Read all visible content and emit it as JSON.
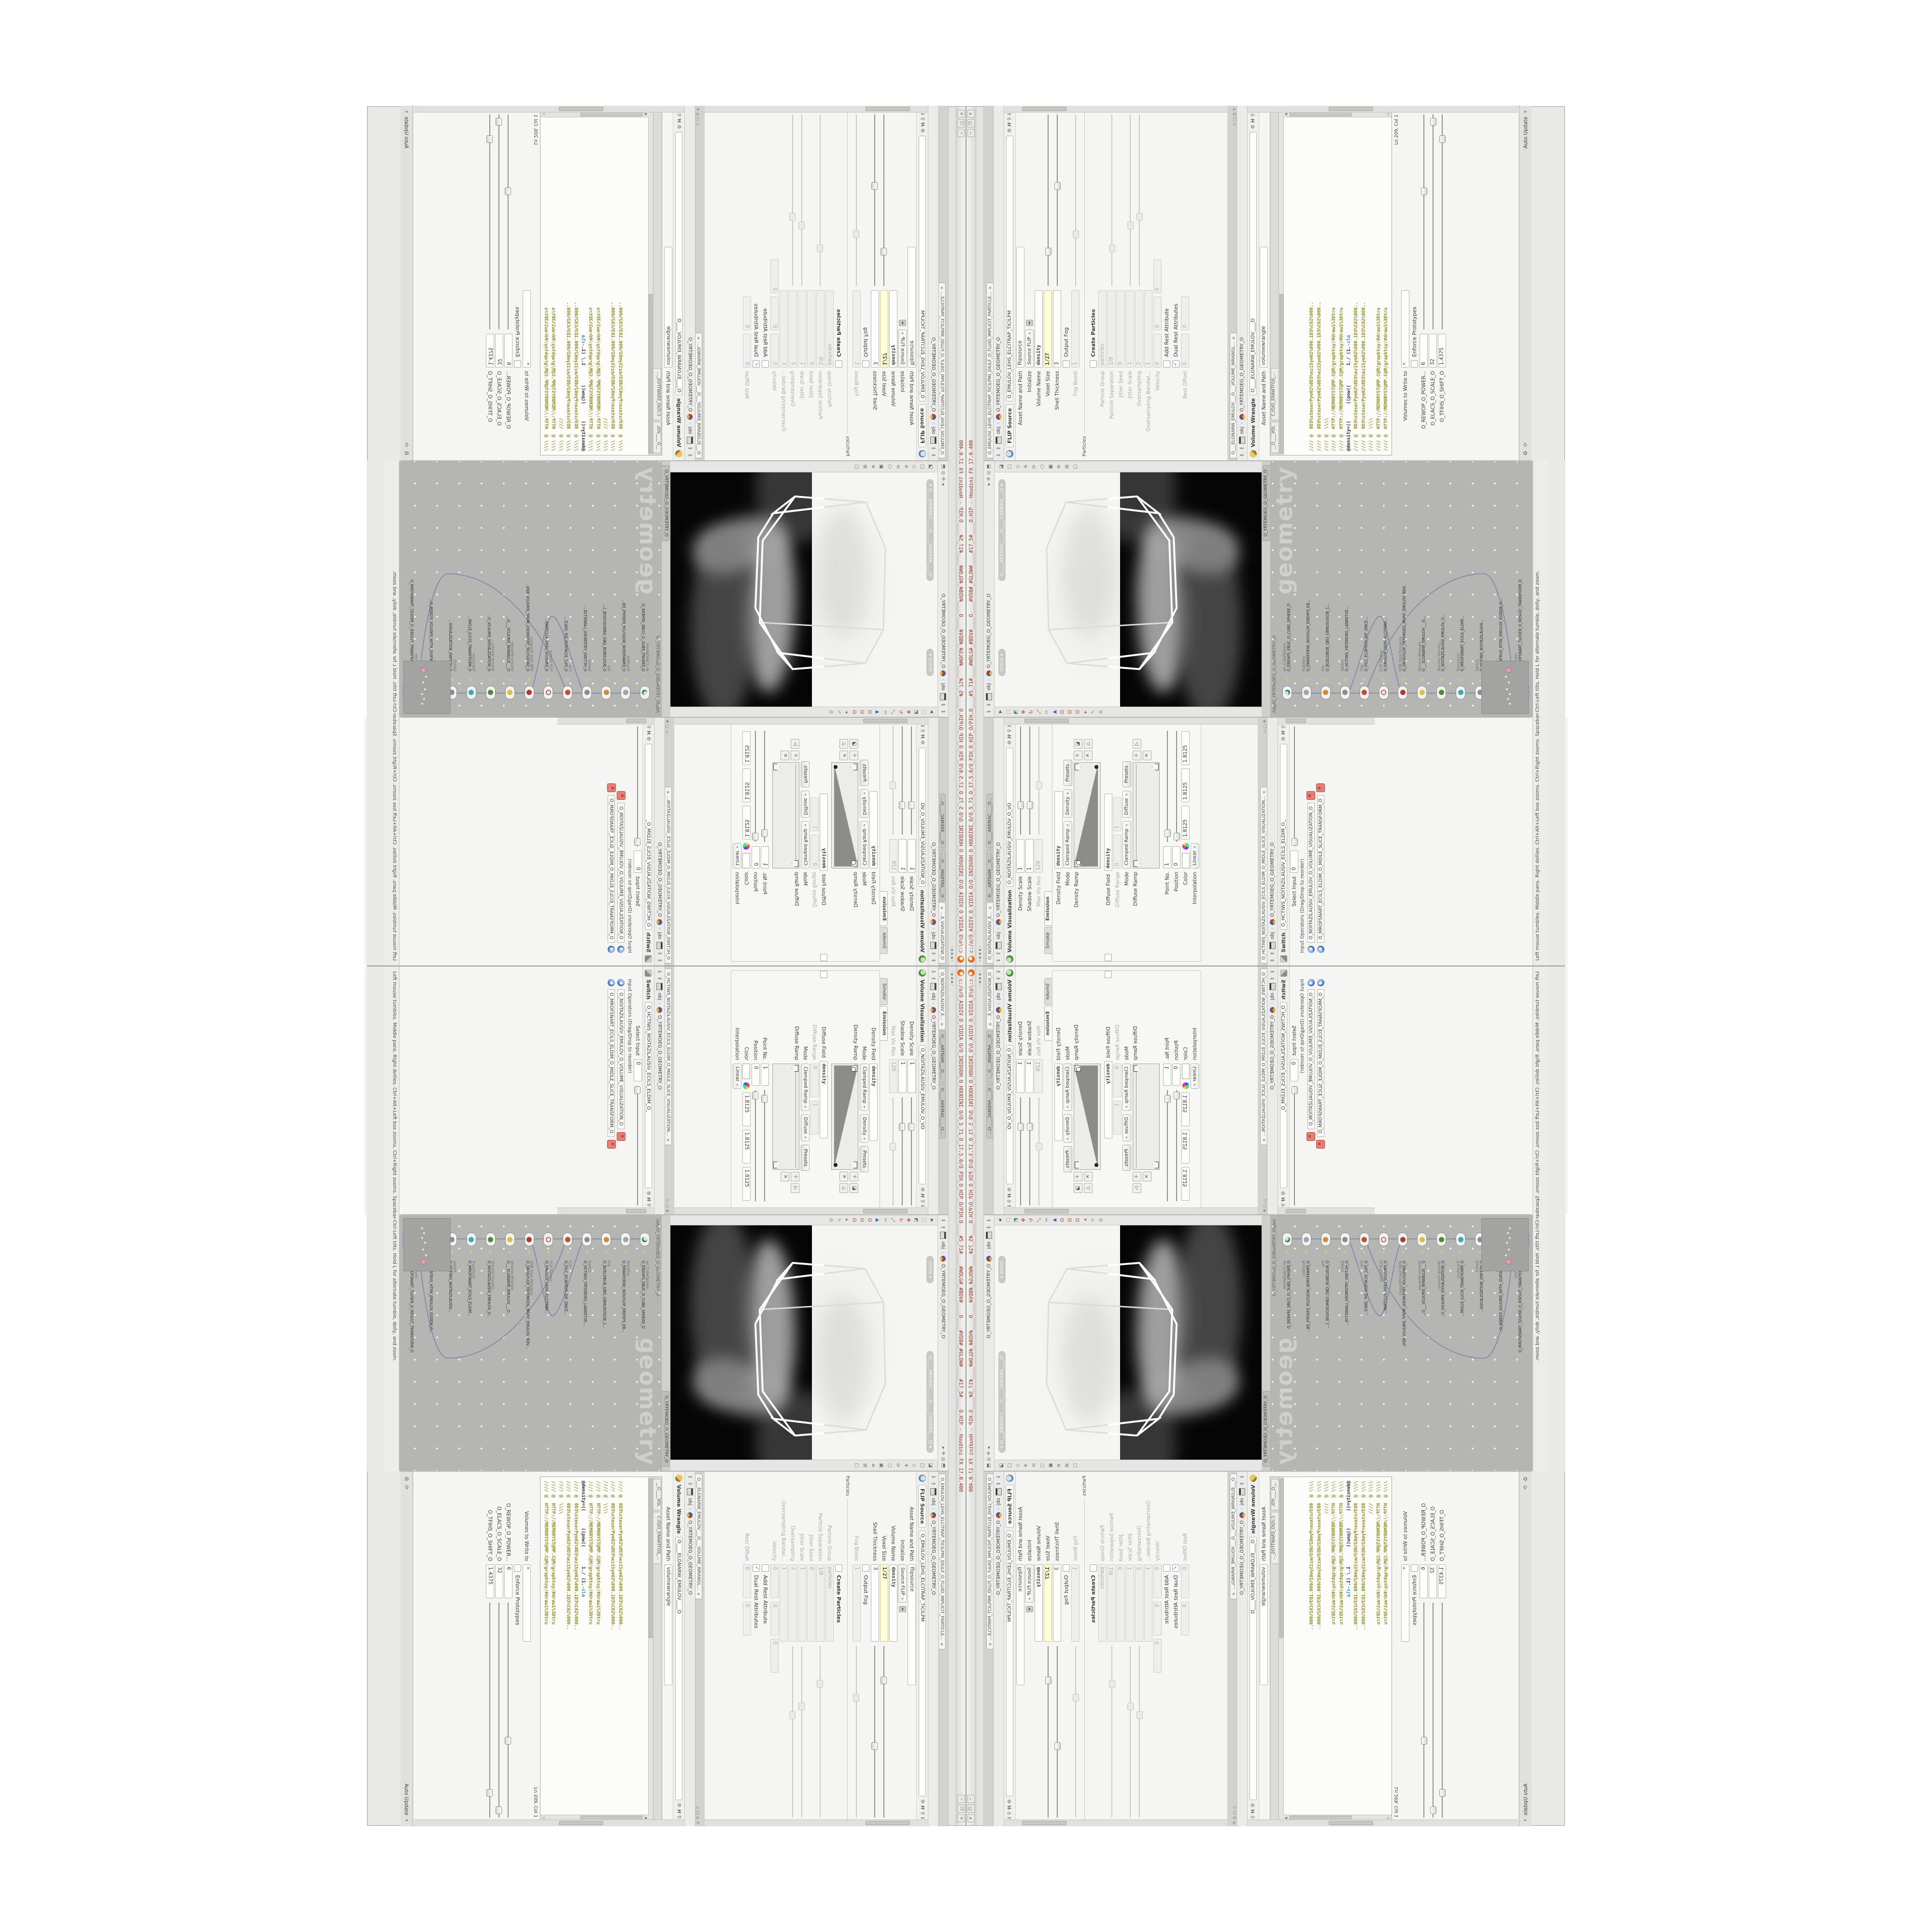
{
  "window": {
    "title": "c:/o/O_AIDIV_O_VIDIA_O/O_INIDUOH_O_HOUDINI_O/O_5_71_O_17.5.0/O_PIH_O_HIP_O/PIH.O____#5_71#____#WOLG#_#BDV#____O____#VDB#_#GLOW#____#17_5#____O.HIP - Houdini FX 17.0.400",
    "buttons": [
      {
        "g": "─"
      },
      {
        "g": "❐"
      },
      {
        "g": "✕"
      }
    ]
  },
  "shelf_hint": "‹ ▪ ▪ ▪ ›",
  "status": "Left mouse tumbles.  Middle pans.  Right dollies.  Ctrl+Alt+Left box zooms.  Ctrl+Right zooms.  Spacebar-Ctrl-Left tilts.  Hold L for alternate tumble, dolly, and zoom.",
  "path": {
    "context": "obj",
    "node": "O_YRTEMOEG_O_GEOMETRY_O",
    "sep": "›"
  },
  "left": {
    "tabs": [
      {
        "t": "O_NOITAZILAUSIV_E...",
        "cls": "active",
        "x": true
      },
      {
        "t": "O___ARTNAM___O_...",
        "x": false
      },
      {
        "t": "O____AREMAC____O...",
        "x": false
      }
    ],
    "volvis": {
      "title": "Volume Visualization",
      "name_field": "O_NOITAZILAUSIV_EMULOV_O_VO",
      "density_scale_label": "Density Scale",
      "density_scale": "1",
      "shadow_scale_label": "Shadow Scale",
      "shadow_scale": "1",
      "max_vis_res_label": "Max Vis Res",
      "max_vis_res": "128",
      "tab_smoke": "Smoke",
      "tab_emission": "Emission",
      "density_field_label": "Density Field",
      "density_field": "density",
      "mode_label": "Mode",
      "mode1a": "Clamped Ramp",
      "mode1b": "Density",
      "presets": "Presets",
      "density_ramp_label": "Density Ramp",
      "diffuse_field_label": "Diffuse Field",
      "diffuse_field": "density",
      "diffuse_range_label": "Diffuse Range",
      "diffuse_range_min": "0",
      "diffuse_range_max": "1",
      "mode2a": "Clamped Ramp",
      "mode2b": "Diffuse",
      "diffuse_ramp_label": "Diffuse Ramp",
      "point_no_label": "Point No.",
      "point_no": "1",
      "position_label": "Position",
      "position": "0",
      "color_label": "Color",
      "color_r": "1.8125",
      "color_g": "1.8125",
      "color_b": "1.8125",
      "interpolation_label": "Interpolation",
      "interpolation": "Linear"
    },
    "switch": {
      "tab": "O_HCTIWS_NOITAZILAUSIV_ECILS_ELDIM_O_MIDLE_SLICE_VISUALIZATION...",
      "title": "Switch",
      "name_field": "O_HCTIWS_NOITAZILAUSIV_ECILS_ELDIM_O_",
      "select_input_label": "Select Input",
      "select_input": "0",
      "operators_label": "Input Operators (Drag/Drop to reorder)",
      "operators": [
        {
          "name": "O_NOITAZILAUSIV_EMULOV_O_VOLUME_VISUALIZATION_O"
        },
        {
          "name": "O_MROFSNART_ECILS_ELDIM_O_MIDLE_SLICE_TRANSFORM_O"
        }
      ]
    }
  },
  "viewport": {
    "camera_pill": "O____AREMAC____O____CAMERA___O",
    "ortho_pill": "Ortho",
    "left_tools": [
      {
        "g": "➤",
        "c": "c-dark"
      },
      {
        "g": "⬚",
        "c": "c-grey"
      },
      {
        "g": "◩",
        "c": "c-green"
      },
      {
        "g": "✥",
        "c": "c-red"
      },
      {
        "g": "↻",
        "c": "c-red"
      },
      {
        "g": "⤢",
        "c": "c-red"
      },
      {
        "g": "✂",
        "c": "c-grey"
      },
      {
        "g": "▲",
        "c": "c-blue"
      },
      {
        "g": "Ω",
        "c": "c-red"
      },
      {
        "g": "Ω",
        "c": "c-red"
      },
      {
        "g": "Ω",
        "c": "c-red"
      },
      {
        "g": "▸",
        "c": "c-grey"
      },
      {
        "g": "✎",
        "c": "c-yellow"
      },
      {
        "g": "⊙",
        "c": "c-grey"
      }
    ],
    "right_tools": [
      {
        "g": "◪",
        "c": "c-grey"
      },
      {
        "g": "□",
        "c": "c-grey"
      },
      {
        "g": "◇",
        "c": "c-grey"
      },
      {
        "g": "✛",
        "c": "c-grey"
      },
      {
        "g": "⟳",
        "c": "c-grey"
      },
      {
        "g": "⬡",
        "c": "c-grey"
      },
      {
        "g": "▣",
        "c": "c-grey"
      },
      {
        "g": "≡",
        "c": "c-grey"
      },
      {
        "g": "⊞",
        "c": "c-grey"
      },
      {
        "g": "▢",
        "c": "c-grey"
      }
    ]
  },
  "network": {
    "tab": "O_YRTEMOEG_O_GEOMETRY_O",
    "path": "/obj/O_YRTEMOEG_O_GEOMETRY_O",
    "watermark": "geometry",
    "nodes": [
      {
        "type": "an_CubeSphere",
        "name": "O_EREHPS_EBUC_O_CUBE_SPHERE_O",
        "icon": "globe"
      },
      {
        "type": "PolyWire",
        "name": "O_EMARFERIW_NOGYLOP_EREHPS_EB...",
        "icon": "wire"
      },
      {
        "type": "File",
        "name": "O_BUSLDBUB_QBO_GBNUSOGOB_1...",
        "icon": "file"
      },
      {
        "type": "Switch",
        "name": "O_HCTIWS_YRTEMOEG_LANRETXE...",
        "icon": "switch"
      },
      {
        "type": "Clip",
        "name": "O_PILC_ECAFRUS_DIF_DNCE...",
        "icon": "clip"
      },
      {
        "type": "FLIP Source",
        "name": "O_EMULOV_LEHS_ELCITRAP...",
        "icon": "flipn"
      },
      {
        "type": "VDB from Polygons",
        "name": "O_SNOGYLOP_YRTEMOEG_MORF_EMULOV_BDV...",
        "icon": "vdb"
      },
      {
        "type": "Volume Wrangle",
        "name": "O___ELGNARW_EMULOV___O...",
        "icon": "wrangn"
      },
      {
        "type": "Volume Visualiz...",
        "name": "O_NOITAZILAUSIV_EMULOV_O...",
        "icon": "volvisn"
      },
      {
        "type": "Transform",
        "name": "O_MROFSNART_ECILS_ELDIM...",
        "icon": "xform"
      },
      {
        "type": "Switch",
        "name": "O_HCTIWS_NOITAZILAUSIV...",
        "icon": "switch"
      },
      {
        "type": "Merge",
        "name": "O_ECAFRUS_HTIW_EMULOV_EGREM_O...",
        "icon": "merge"
      },
      {
        "type": "Transform",
        "name": "O_MROFSNART_TLUSER_O_RESULT_TRANSFORM_O",
        "icon": "xform",
        "cls": "sel"
      }
    ]
  },
  "flip": {
    "tab": "O_EMULOV_LEHS_ELCITRAP_TICILPMI_DIULF_O_FLUID_IMPLICIT_PARTICLE...",
    "node_type": "FLIP Source",
    "node_name": "O_EMULOV_LEHS_ELCITRAP_TICILPM",
    "asset_label": "Asset Name and Path",
    "asset": "flipsource",
    "initialize_label": "Initialize",
    "initialize": "Source FLIP",
    "volume_name_label": "Volume Name",
    "volume_name": "density",
    "voxel_size_label": "Voxel Size",
    "voxel_size": "1/27",
    "shell_label": "Shell Thickness",
    "shell": "3",
    "output_fog_label": "Output Fog",
    "fog_boost_label": "Fog Boost",
    "fog_boost": "1",
    "particles_section": "Particles",
    "create_particles_label": "Create Particles",
    "particle_group_label": "Particle Group",
    "particle_group": "particles",
    "particle_separation_label": "Particle Separation",
    "particle_separation": "1/9",
    "jitter_seed_label": "Jitter Seed",
    "jitter_seed": "0",
    "jitter_scale_label": "Jitter Scale",
    "jitter_scale": "1",
    "oversampling_label": "Oversampling",
    "oversampling": "2",
    "oversampling_bw_label": "Oversampling Bandwi...",
    "oversampling_bw": "1",
    "velocity_label": "Velocity",
    "vel_x": "0",
    "vel_y": "0",
    "vel_z": "0",
    "add_rest_label": "Add Rest Attribute",
    "dual_rest_label": "Dual Rest Attributes",
    "dual_rest_check": "✓",
    "rest_offset_label": "Rest Offset",
    "rest_offset": "0"
  },
  "wrangle": {
    "tab": "O___ELGNARW_EMULOV___O___VOLUME_WRANGL...",
    "node_type": "Volume Wrangle",
    "node_name": "O____ELGNARW_EMULOV____O",
    "asset_label": "Asset Name and Path",
    "asset": "volumewrangle",
    "editor_tabs": [
      {
        "t": "__O____VOL"
      },
      {
        "t": "C:/O/O_ERAWTFOS_..."
      }
    ],
    "code": [
      {
        "a": "//// @  0D3%steserPym62%0D3%eziSym62%000.1D3%C62%000..",
        "b": "",
        "cls": "ln-olive"
      },
      {
        "a": "//// @  0D3%steserPym62%0D3%eziSym62%000.1D3%C62%000..",
        "b": "",
        "cls": "ln-olive"
      },
      {
        "a": "//// @  \\\\\\\\",
        "b": "",
        "cls": "ln-olive"
      },
      {
        "a": "//// @  HTTP://MEMORYST@MP.C@M/graphtoy/#draw1%3Dtru",
        "b": "",
        "cls": "ln-olive"
      },
      {
        "a": "//// @  HTTP://MEMORYST@MP.C@M/graphtoy/#draw1%3Dtru",
        "b": "",
        "cls": "ln-olive"
      },
      {
        "a": "@density=((      ((pow((       1./ (1.",
        "b": "-cla",
        "cls": "ln-dark"
      },
      {
        "a": "//// @  0D3%steserPym62%0D3%eziSym62%000.1D3%C62%000..",
        "b": "",
        "cls": "ln-olive"
      },
      {
        "a": "//// @  0D3%steserPym62%0D3%eziSym62%000.1D3%C62%000..",
        "b": "",
        "cls": "ln-olive"
      },
      {
        "a": "//// @  \\\\\\\\",
        "b": "",
        "cls": "ln-olive"
      },
      {
        "a": "//// @  HTTP://MEMORYST@MP.C@M/graphtoy/#draw1%3Dtru",
        "b": "",
        "cls": "ln-olive"
      },
      {
        "a": "//// @  HTTP://MEMORYST@MP.C@M/graphtoy/#draw1%3Dtru",
        "b": "",
        "cls": "ln-olive"
      }
    ],
    "ln_status": "Ln 209, Col 1",
    "volumes_label": "Volumes to Write to",
    "volumes": "*",
    "enforce_label": "Enforce Prototypes",
    "power_label": "O_REWOP_O_POWER...",
    "power": "6",
    "scale_label": "O_ELACS_O_SCALE_O",
    "scale": "32",
    "shift_label": "O_TFIHS_O_SHIFT_O",
    "shift": "1.4375"
  },
  "autoupdate": {
    "label": "Auto Update",
    "arrow": "▾"
  }
}
